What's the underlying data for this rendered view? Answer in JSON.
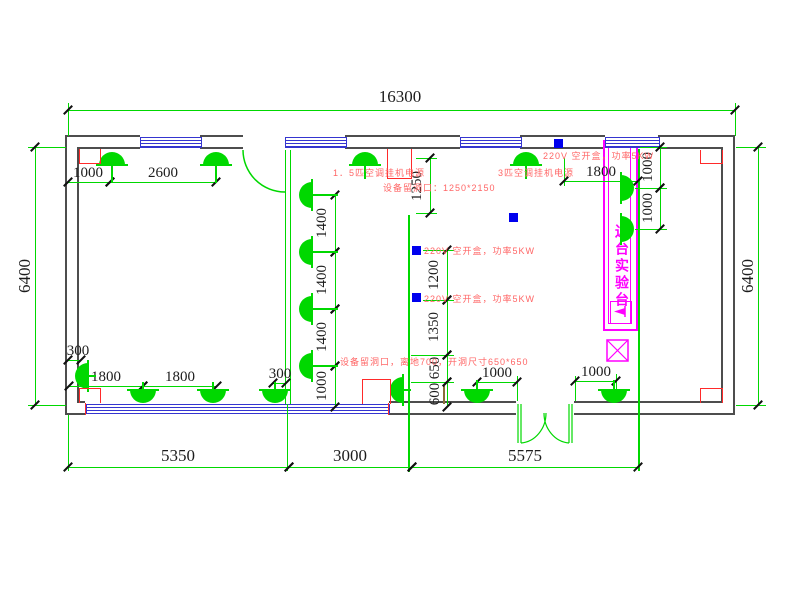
{
  "drawing_type": "electrical-lighting floor plan (CAD)",
  "colors": {
    "wall": "#4d4d4d",
    "object_green": "#00d800",
    "window_blue": "#3535d0",
    "socket_blue": "#0000ee",
    "marker_red": "#ff2a2a",
    "annotation_red": "#ff6666",
    "bench_magenta": "#ff00ff",
    "dim_text": "#1c1c1c"
  },
  "labels": {
    "bench": "边台实验台"
  },
  "annotations": [
    {
      "text": "1．5匹空调挂机电源",
      "x": 333,
      "y": 166
    },
    {
      "text": "3匹空调挂机电源",
      "x": 498,
      "y": 166
    },
    {
      "text": "设备留洞口：1250*2150",
      "x": 383,
      "y": 181
    },
    {
      "text": "220V 空开盒，功率5KW",
      "x": 543,
      "y": 149
    },
    {
      "text": "220V 空开盒，功率5KW",
      "x": 424,
      "y": 244
    },
    {
      "text": "220V 空开盒，功率5KW",
      "x": 424,
      "y": 292
    },
    {
      "text": "设备留洞口，离地700，开洞尺寸650*650",
      "x": 340,
      "y": 355
    }
  ],
  "dims_h": [
    {
      "label": "16300",
      "x1": 68,
      "x2": 735,
      "y": 110,
      "tx": 400,
      "ty": 88,
      "lg": true
    },
    {
      "label": "1000",
      "x1": 68,
      "x2": 110,
      "y": 182,
      "tx": 88,
      "ty": 164,
      "lg": false
    },
    {
      "label": "2600",
      "x1": 110,
      "x2": 216,
      "y": 182,
      "tx": 163,
      "ty": 164,
      "lg": false
    },
    {
      "label": "1800",
      "x1": 564,
      "x2": 638,
      "y": 181,
      "tx": 601,
      "ty": 163,
      "lg": false
    },
    {
      "label": "300",
      "x1": 68,
      "x2": 81,
      "y": 360,
      "tx": 78,
      "ty": 342,
      "lg": false
    },
    {
      "label": "1800",
      "x1": 69,
      "x2": 143,
      "y": 386,
      "tx": 106,
      "ty": 368,
      "lg": false
    },
    {
      "label": "1800",
      "x1": 143,
      "x2": 217,
      "y": 386,
      "tx": 180,
      "ty": 368,
      "lg": false
    },
    {
      "label": "300",
      "x1": 273,
      "x2": 286,
      "y": 383,
      "tx": 280,
      "ty": 365,
      "lg": false
    },
    {
      "label": "1000",
      "x1": 477,
      "x2": 517,
      "y": 382,
      "tx": 497,
      "ty": 364,
      "lg": false
    },
    {
      "label": "1000",
      "x1": 575,
      "x2": 616,
      "y": 381,
      "tx": 596,
      "ty": 363,
      "lg": false
    },
    {
      "label": "5350",
      "x1": 68,
      "x2": 289,
      "y": 467,
      "tx": 178,
      "ty": 447,
      "lg": true
    },
    {
      "label": "3000",
      "x1": 289,
      "x2": 412,
      "y": 467,
      "tx": 350,
      "ty": 447,
      "lg": true
    },
    {
      "label": "5575",
      "x1": 412,
      "x2": 638,
      "y": 467,
      "tx": 525,
      "ty": 447,
      "lg": true
    }
  ],
  "dims_v": [
    {
      "label": "6400",
      "x": 35,
      "y1": 147,
      "y2": 405,
      "tx": 25,
      "ty": 276,
      "lg": true
    },
    {
      "label": "6400",
      "x": 758,
      "y1": 147,
      "y2": 405,
      "tx": 748,
      "ty": 276,
      "lg": true
    },
    {
      "label": "1400",
      "x": 335,
      "y1": 195,
      "y2": 252,
      "tx": 322,
      "ty": 223,
      "lg": false
    },
    {
      "label": "1400",
      "x": 335,
      "y1": 252,
      "y2": 309,
      "tx": 322,
      "ty": 280,
      "lg": false
    },
    {
      "label": "1400",
      "x": 335,
      "y1": 309,
      "y2": 366,
      "tx": 322,
      "ty": 337,
      "lg": false
    },
    {
      "label": "1000",
      "x": 335,
      "y1": 366,
      "y2": 407,
      "tx": 322,
      "ty": 386,
      "lg": false
    },
    {
      "label": "1250",
      "x": 430,
      "y1": 158,
      "y2": 213,
      "tx": 417,
      "ty": 186,
      "lg": false
    },
    {
      "label": "1200",
      "x": 447,
      "y1": 250,
      "y2": 300,
      "tx": 434,
      "ty": 275,
      "lg": false
    },
    {
      "label": "1350",
      "x": 447,
      "y1": 300,
      "y2": 355,
      "tx": 434,
      "ty": 327,
      "lg": false
    },
    {
      "label": "650",
      "x": 447,
      "y1": 355,
      "y2": 382,
      "tx": 435,
      "ty": 368,
      "lg": false
    },
    {
      "label": "600",
      "x": 447,
      "y1": 382,
      "y2": 407,
      "tx": 435,
      "ty": 394,
      "lg": false
    },
    {
      "label": "1000",
      "x": 660,
      "y1": 147,
      "y2": 188,
      "tx": 648,
      "ty": 167,
      "lg": false
    },
    {
      "label": "1000",
      "x": 660,
      "y1": 188,
      "y2": 229,
      "tx": 648,
      "ty": 208,
      "lg": false
    }
  ],
  "fixtures": [
    {
      "x": 112,
      "y": 165,
      "dir": "up",
      "stem": 18
    },
    {
      "x": 216,
      "y": 165,
      "dir": "up",
      "stem": 18
    },
    {
      "x": 365,
      "y": 165,
      "dir": "up",
      "stem": 14
    },
    {
      "x": 526,
      "y": 165,
      "dir": "up",
      "stem": 14
    },
    {
      "x": 143,
      "y": 390,
      "dir": "down",
      "stem": 8
    },
    {
      "x": 213,
      "y": 390,
      "dir": "down",
      "stem": 8
    },
    {
      "x": 275,
      "y": 390,
      "dir": "down",
      "stem": 8
    },
    {
      "x": 477,
      "y": 390,
      "dir": "down",
      "stem": 10
    },
    {
      "x": 614,
      "y": 390,
      "dir": "down",
      "stem": 10
    },
    {
      "x": 88,
      "y": 376,
      "dir": "left",
      "stem": 8
    },
    {
      "x": 403,
      "y": 390,
      "dir": "left",
      "stem": 8
    },
    {
      "x": 312,
      "y": 195,
      "dir": "left",
      "stem": 26
    },
    {
      "x": 312,
      "y": 252,
      "dir": "left",
      "stem": 26
    },
    {
      "x": 312,
      "y": 309,
      "dir": "left",
      "stem": 26
    },
    {
      "x": 312,
      "y": 366,
      "dir": "left",
      "stem": 26
    },
    {
      "x": 621,
      "y": 188,
      "dir": "right",
      "stem": 0
    },
    {
      "x": 621,
      "y": 229,
      "dir": "right",
      "stem": 0
    }
  ],
  "windows_top": [
    {
      "x": 140,
      "w": 60
    },
    {
      "x": 285,
      "w": 60
    },
    {
      "x": 460,
      "w": 60
    },
    {
      "x": 605,
      "w": 53
    }
  ],
  "blue_squares": [
    {
      "x": 554,
      "y": 139
    },
    {
      "x": 509,
      "y": 213
    },
    {
      "x": 412,
      "y": 246
    },
    {
      "x": 412,
      "y": 293
    }
  ],
  "red_boxes": [
    {
      "x": 79,
      "y": 149,
      "w": 20,
      "h": 14,
      "open": "top"
    },
    {
      "x": 700,
      "y": 150,
      "w": 21,
      "h": 13,
      "open": "top"
    },
    {
      "x": 79,
      "y": 388,
      "w": 20,
      "h": 14,
      "open": "bottom"
    },
    {
      "x": 700,
      "y": 388,
      "w": 21,
      "h": 14,
      "open": "bottom"
    },
    {
      "x": 387,
      "y": 149,
      "w": 23,
      "h": 29,
      "open": "top"
    },
    {
      "x": 362,
      "y": 379,
      "w": 27,
      "h": 24,
      "open": "bottom"
    }
  ],
  "ext_lines_v": [
    {
      "x": 68,
      "y1": 103,
      "y2": 136
    },
    {
      "x": 735,
      "y1": 103,
      "y2": 136
    },
    {
      "x": 68,
      "y1": 415,
      "y2": 471
    },
    {
      "x": 287,
      "y1": 404,
      "y2": 471
    },
    {
      "x": 564,
      "y1": 158,
      "y2": 186
    },
    {
      "x": 517,
      "y1": 376,
      "y2": 401
    },
    {
      "x": 575,
      "y1": 376,
      "y2": 401
    },
    {
      "x": 616,
      "y1": 374,
      "y2": 390
    }
  ],
  "ext_lines_h": [
    {
      "y": 147,
      "x1": 28,
      "x2": 66
    },
    {
      "y": 405,
      "x1": 28,
      "x2": 66
    },
    {
      "y": 147,
      "x1": 736,
      "x2": 766
    },
    {
      "y": 405,
      "x1": 736,
      "x2": 766
    },
    {
      "y": 158,
      "x1": 416,
      "x2": 437
    },
    {
      "y": 213,
      "x1": 416,
      "x2": 437
    },
    {
      "y": 250,
      "x1": 423,
      "x2": 454
    },
    {
      "y": 300,
      "x1": 423,
      "x2": 454
    },
    {
      "y": 355,
      "x1": 411,
      "x2": 454
    },
    {
      "y": 382,
      "x1": 411,
      "x2": 454
    },
    {
      "y": 147,
      "x1": 640,
      "x2": 667
    },
    {
      "y": 188,
      "x1": 635,
      "x2": 667
    },
    {
      "y": 229,
      "x1": 635,
      "x2": 667
    }
  ],
  "object_lines_v": [
    {
      "x": 408,
      "y": 215,
      "h": 257,
      "color": "#00d800"
    },
    {
      "x": 638,
      "y": 149,
      "h": 322,
      "color": "#00d800"
    },
    {
      "x": 443,
      "y": 386,
      "h": 18,
      "color": "#8a6d3b"
    }
  ]
}
